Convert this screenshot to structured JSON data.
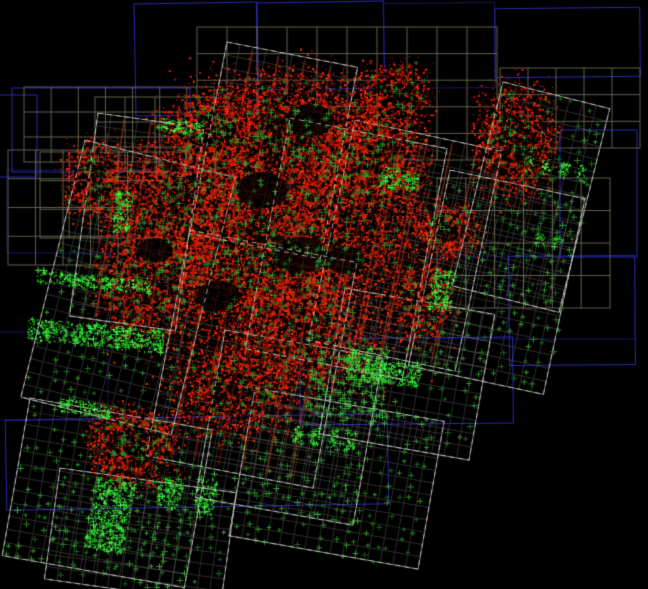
{
  "canvas": {
    "width": 648,
    "height": 589,
    "background": "#000000"
  },
  "colors": {
    "background": "#000000",
    "blue_outline": "#2a2cb0",
    "blue_dim": "#1a1a78",
    "olive_grid": "#6f6f58",
    "field_border": "#d2d6cd",
    "field_grid": "#91948a",
    "red_points": [
      "#b50f00",
      "#e61c00",
      "#ff3300"
    ],
    "red_streak": "#ff1e00",
    "green_cross": [
      "#1e731e",
      "#2a9429",
      "#36ad36"
    ],
    "green_bright": [
      "#1ecc1e",
      "#2ee62e",
      "#49ff49"
    ]
  },
  "seed": 1337,
  "blue_rects": [
    {
      "x": 135,
      "y": 3,
      "w": 123,
      "h": 112,
      "rot": -1,
      "tone": "bright"
    },
    {
      "x": 257,
      "y": 2,
      "w": 127,
      "h": 87,
      "rot": -1,
      "tone": "bright"
    },
    {
      "x": 384,
      "y": 3,
      "w": 111,
      "h": 85,
      "rot": -0.5,
      "tone": "dim"
    },
    {
      "x": 495,
      "y": 8,
      "w": 145,
      "h": 69,
      "rot": -0.5,
      "tone": "bright"
    },
    {
      "x": 12,
      "y": 88,
      "w": 178,
      "h": 84,
      "rot": 0,
      "tone": "bright"
    },
    {
      "x": -22,
      "y": 95,
      "w": 59,
      "h": 82,
      "rot": 0,
      "tone": "bright"
    },
    {
      "x": 7,
      "y": 170,
      "w": 185,
      "h": 83,
      "rot": 0,
      "tone": "dim"
    },
    {
      "x": -22,
      "y": 332,
      "w": 130,
      "h": 88,
      "rot": 0,
      "tone": "dim"
    },
    {
      "x": 6,
      "y": 417,
      "w": 382,
      "h": 90,
      "rot": -1,
      "tone": "bright"
    },
    {
      "x": 560,
      "y": 130,
      "w": 77,
      "h": 127,
      "rot": 0,
      "tone": "bright"
    },
    {
      "x": 509,
      "y": 256,
      "w": 126,
      "h": 109,
      "rot": -0.5,
      "tone": "bright"
    },
    {
      "x": 437,
      "y": 256,
      "w": 198,
      "h": 83,
      "rot": 0,
      "tone": "dim"
    },
    {
      "x": 300,
      "y": 338,
      "w": 213,
      "h": 86,
      "rot": -0.5,
      "tone": "bright"
    }
  ],
  "olive_grids": [
    {
      "x": 197,
      "y": 27,
      "w": 300,
      "h": 133,
      "cols": 10,
      "rows": 5
    },
    {
      "x": 24,
      "y": 87,
      "w": 190,
      "h": 75,
      "cols": 7,
      "rows": 3
    },
    {
      "x": 95,
      "y": 97,
      "w": 120,
      "h": 75,
      "cols": 4,
      "rows": 3
    },
    {
      "x": 8,
      "y": 150,
      "w": 110,
      "h": 115,
      "cols": 4,
      "rows": 4
    },
    {
      "x": 40,
      "y": 152,
      "w": 175,
      "h": 86,
      "cols": 6,
      "rows": 3
    },
    {
      "x": 500,
      "y": 68,
      "w": 140,
      "h": 80,
      "cols": 5,
      "rows": 3
    },
    {
      "x": 437,
      "y": 178,
      "w": 173,
      "h": 130,
      "cols": 6,
      "rows": 4
    }
  ],
  "fields": [
    {
      "x": 227,
      "y": 42,
      "w": 133,
      "h": 195,
      "rot": 11,
      "fill": "red"
    },
    {
      "x": 98,
      "y": 113,
      "w": 107,
      "h": 205,
      "rot": 8,
      "fill": "red"
    },
    {
      "x": 85,
      "y": 140,
      "w": 155,
      "h": 265,
      "rot": 14,
      "fill": "green",
      "cross_area": [
        0,
        0.4,
        1,
        1
      ]
    },
    {
      "x": 30,
      "y": 398,
      "w": 185,
      "h": 160,
      "rot": 10,
      "fill": "green",
      "cross_area": [
        0,
        0,
        1,
        1
      ]
    },
    {
      "x": 60,
      "y": 468,
      "w": 178,
      "h": 112,
      "rot": 8,
      "fill": "green",
      "cross_area": [
        0,
        0,
        1,
        1
      ]
    },
    {
      "x": 190,
      "y": 230,
      "w": 170,
      "h": 230,
      "rot": 11,
      "fill": "red"
    },
    {
      "x": 290,
      "y": 118,
      "w": 160,
      "h": 235,
      "rot": 11,
      "fill": "red"
    },
    {
      "x": 355,
      "y": 120,
      "w": 150,
      "h": 225,
      "rot": 12,
      "fill": "red"
    },
    {
      "x": 503,
      "y": 82,
      "w": 110,
      "h": 210,
      "rot": 14,
      "fill": "green",
      "cross_area": [
        0.4,
        0,
        1,
        1
      ]
    },
    {
      "x": 450,
      "y": 170,
      "w": 138,
      "h": 200,
      "rot": 12,
      "fill": "green",
      "cross_area": [
        0,
        0,
        1,
        1
      ]
    },
    {
      "x": 255,
      "y": 388,
      "w": 192,
      "h": 150,
      "rot": 10,
      "fill": "green",
      "cross_area": [
        0,
        0,
        1,
        1
      ]
    },
    {
      "x": 345,
      "y": 288,
      "w": 152,
      "h": 148,
      "rot": 10,
      "fill": "green",
      "cross_area": [
        0,
        0.3,
        1,
        1
      ]
    },
    {
      "x": 225,
      "y": 330,
      "w": 160,
      "h": 170,
      "rot": 10,
      "fill": "green",
      "cross_area": [
        0,
        0.5,
        1,
        1
      ]
    }
  ],
  "red_clusters": [
    [
      285,
      135,
      115,
      80,
      6500
    ],
    [
      180,
      205,
      85,
      75,
      4200
    ],
    [
      262,
      252,
      105,
      85,
      5800
    ],
    [
      350,
      205,
      85,
      95,
      4200
    ],
    [
      152,
      282,
      68,
      65,
      2800
    ],
    [
      300,
      330,
      90,
      75,
      3600
    ],
    [
      232,
      388,
      78,
      58,
      2400
    ],
    [
      133,
      445,
      52,
      45,
      2200
    ],
    [
      515,
      140,
      48,
      68,
      2300
    ],
    [
      445,
      230,
      42,
      34,
      1100
    ],
    [
      395,
      95,
      42,
      40,
      1200
    ],
    [
      420,
      300,
      40,
      50,
      1300
    ],
    [
      95,
      180,
      40,
      45,
      1300
    ],
    [
      270,
      260,
      190,
      170,
      2500
    ],
    [
      375,
      155,
      60,
      55,
      2000
    ],
    [
      210,
      130,
      60,
      45,
      2000
    ]
  ],
  "red_holes": [
    [
      310,
      120,
      24,
      16
    ],
    [
      262,
      190,
      26,
      18
    ],
    [
      300,
      255,
      28,
      18
    ],
    [
      218,
      296,
      22,
      15
    ],
    [
      345,
      260,
      20,
      14
    ],
    [
      155,
      250,
      18,
      12
    ]
  ],
  "green_bands": [
    {
      "x": 37,
      "y": 269,
      "w": 116,
      "h": 13,
      "rot": 6,
      "style": "solid"
    },
    {
      "x": 28,
      "y": 317,
      "w": 138,
      "h": 22,
      "rot": 6,
      "style": "solid"
    },
    {
      "x": 96,
      "y": 476,
      "w": 40,
      "h": 72,
      "rot": 10,
      "style": "solid"
    },
    {
      "x": 200,
      "y": 476,
      "w": 18,
      "h": 36,
      "rot": 10,
      "style": "solid"
    },
    {
      "x": 160,
      "y": 476,
      "w": 24,
      "h": 30,
      "rot": 10,
      "style": "solid"
    },
    {
      "x": 294,
      "y": 424,
      "w": 72,
      "h": 18,
      "rot": 8,
      "style": "dashed"
    },
    {
      "x": 525,
      "y": 155,
      "w": 62,
      "h": 16,
      "rot": 10,
      "style": "dashed"
    },
    {
      "x": 536,
      "y": 232,
      "w": 30,
      "h": 13,
      "rot": 10,
      "style": "dashed"
    },
    {
      "x": 434,
      "y": 268,
      "w": 22,
      "h": 42,
      "rot": 10,
      "style": "solid"
    },
    {
      "x": 348,
      "y": 343,
      "w": 42,
      "h": 36,
      "rot": 8,
      "style": "blob"
    },
    {
      "x": 380,
      "y": 360,
      "w": 42,
      "h": 22,
      "rot": 8,
      "style": "blob"
    },
    {
      "x": 382,
      "y": 166,
      "w": 38,
      "h": 20,
      "rot": 10,
      "style": "blob"
    },
    {
      "x": 60,
      "y": 396,
      "w": 52,
      "h": 15,
      "rot": 10,
      "style": "solid"
    },
    {
      "x": 160,
      "y": 117,
      "w": 45,
      "h": 13,
      "rot": 7,
      "style": "solid"
    },
    {
      "x": 118,
      "y": 190,
      "w": 17,
      "h": 42,
      "rot": 10,
      "style": "solid"
    },
    {
      "x": 315,
      "y": 350,
      "w": 80,
      "h": 65,
      "rot": 10,
      "style": "blob-medium"
    }
  ],
  "cross_params": {
    "spacing": 11,
    "presence": 0.52,
    "size_min": 4,
    "size_max": 7
  }
}
